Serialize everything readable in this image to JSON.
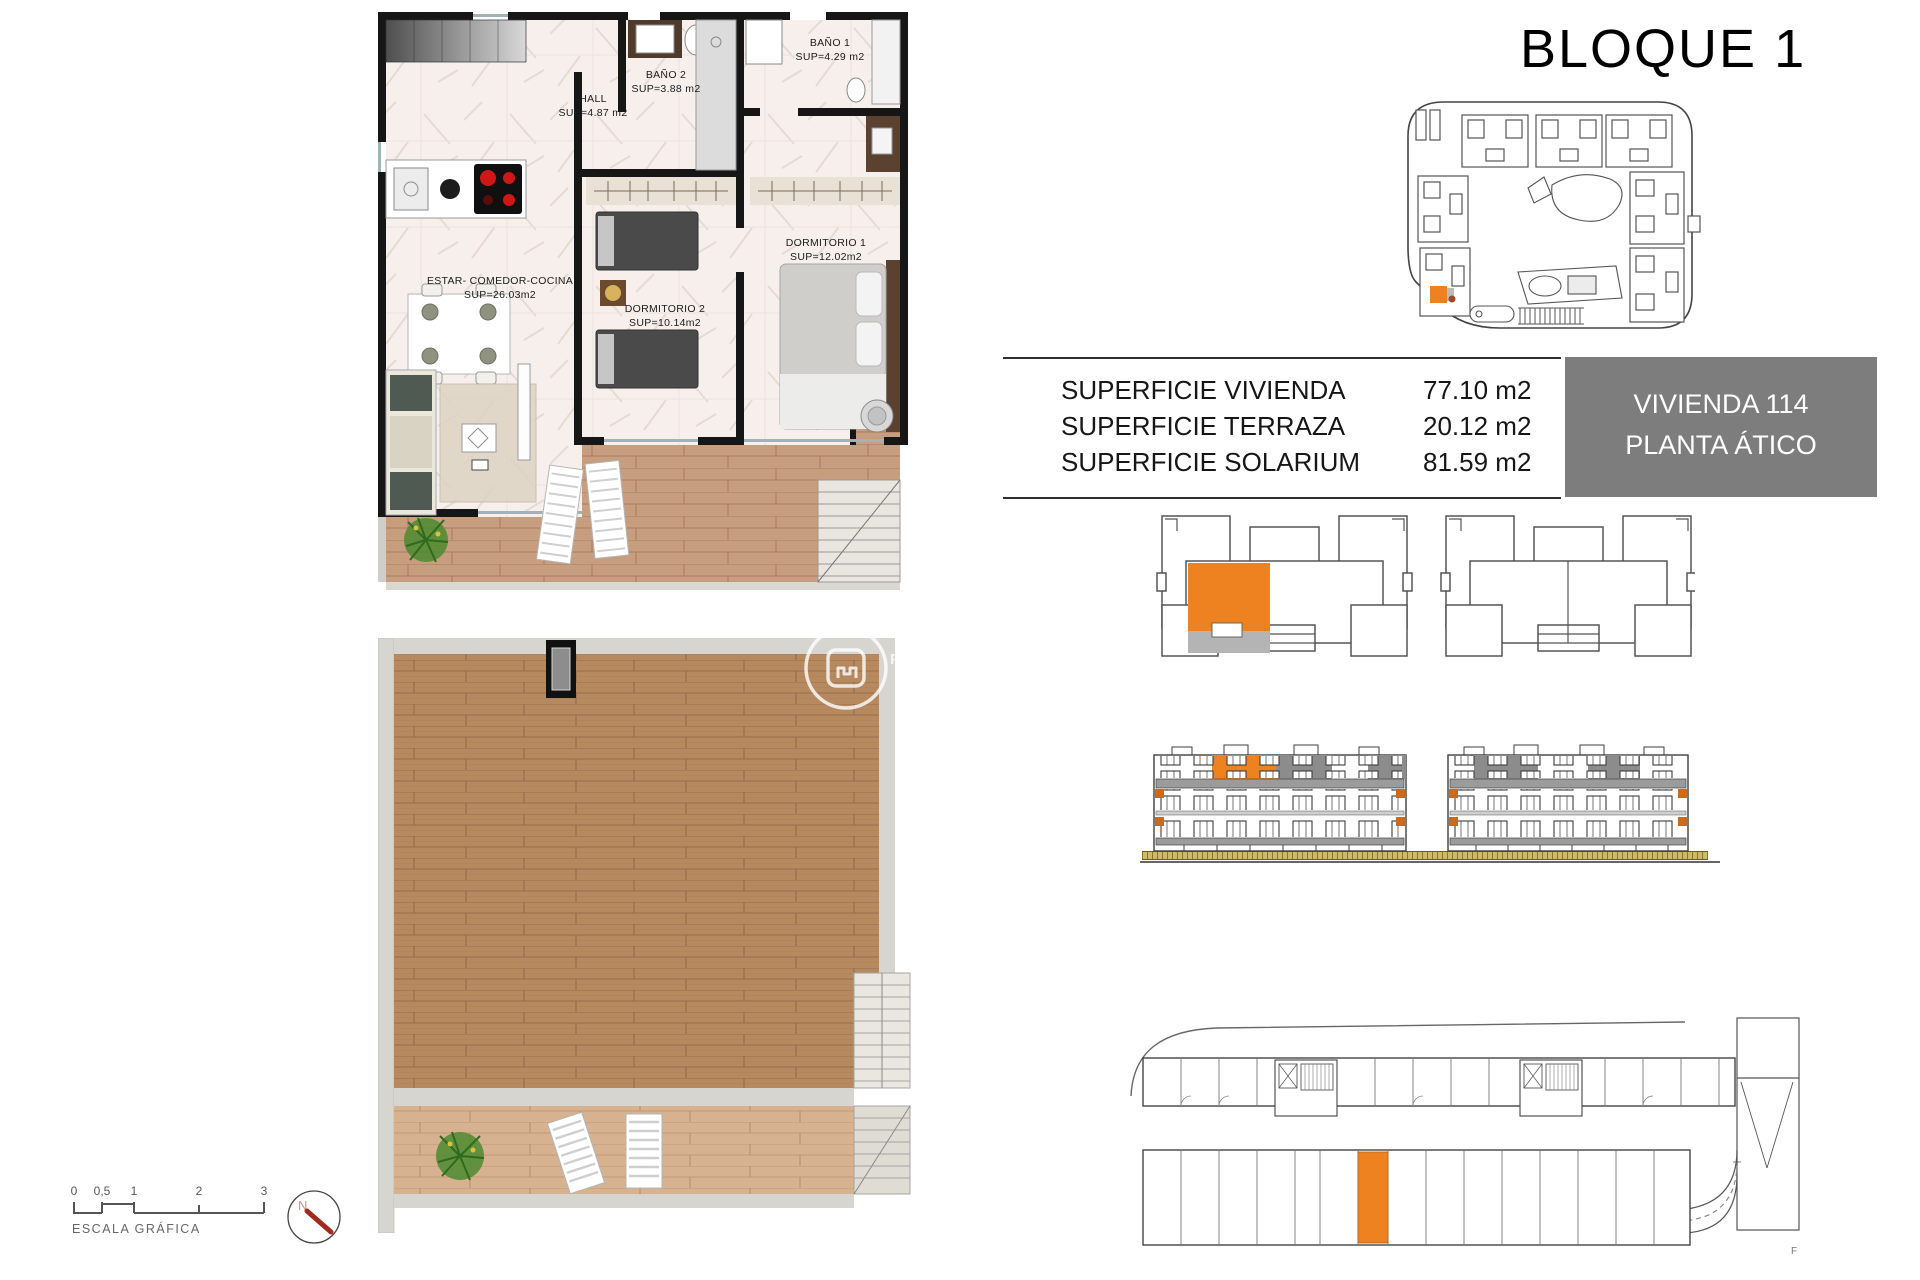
{
  "page": {
    "title": "BLOQUE 1"
  },
  "unit_badge": {
    "line1": "VIVIENDA 114",
    "line2": "PLANTA ÁTICO"
  },
  "areas_table": {
    "rows": [
      {
        "label": "SUPERFICIE VIVIENDA",
        "value": "77.10 m2"
      },
      {
        "label": "SUPERFICIE TERRAZA",
        "value": "20.12 m2"
      },
      {
        "label": "SUPERFICIE SOLARIUM",
        "value": "81.59 m2"
      }
    ]
  },
  "floor_plan": {
    "rooms": [
      {
        "name": "HALL",
        "area": "SUP=4.87 m2"
      },
      {
        "name": "BAÑO 2",
        "area": "SUP=3.88 m2"
      },
      {
        "name": "BAÑO 1",
        "area": "SUP=4.29 m2"
      },
      {
        "name": "ESTAR- COMEDOR-COCINA",
        "area": "SUP=26.03m2"
      },
      {
        "name": "DORMITORIO 2",
        "area": "SUP=10.14m2"
      },
      {
        "name": "DORMITORIO 1",
        "area": "SUP=12.02m2"
      }
    ]
  },
  "scale_bar": {
    "ticks": [
      "0",
      "0,5",
      "1",
      "2",
      "3"
    ],
    "label": "ESCALA GRÁFICA"
  },
  "compass": {
    "north_label": "N"
  },
  "watermark": {
    "letters": "P R"
  },
  "parking_plan": {
    "corner_mark": "F"
  },
  "colors": {
    "highlight_orange": "#EF8220",
    "badge_gray": "#7D7D7D",
    "wall_black": "#161616",
    "terrace_wood": "#C79E7F",
    "solarium_wood": "#B6895F",
    "marble_floor": "#F6EFEC",
    "balcony_gray": "#9B9B9B",
    "ground_olive": "#AD9434",
    "compass_red": "#A32B1D"
  }
}
